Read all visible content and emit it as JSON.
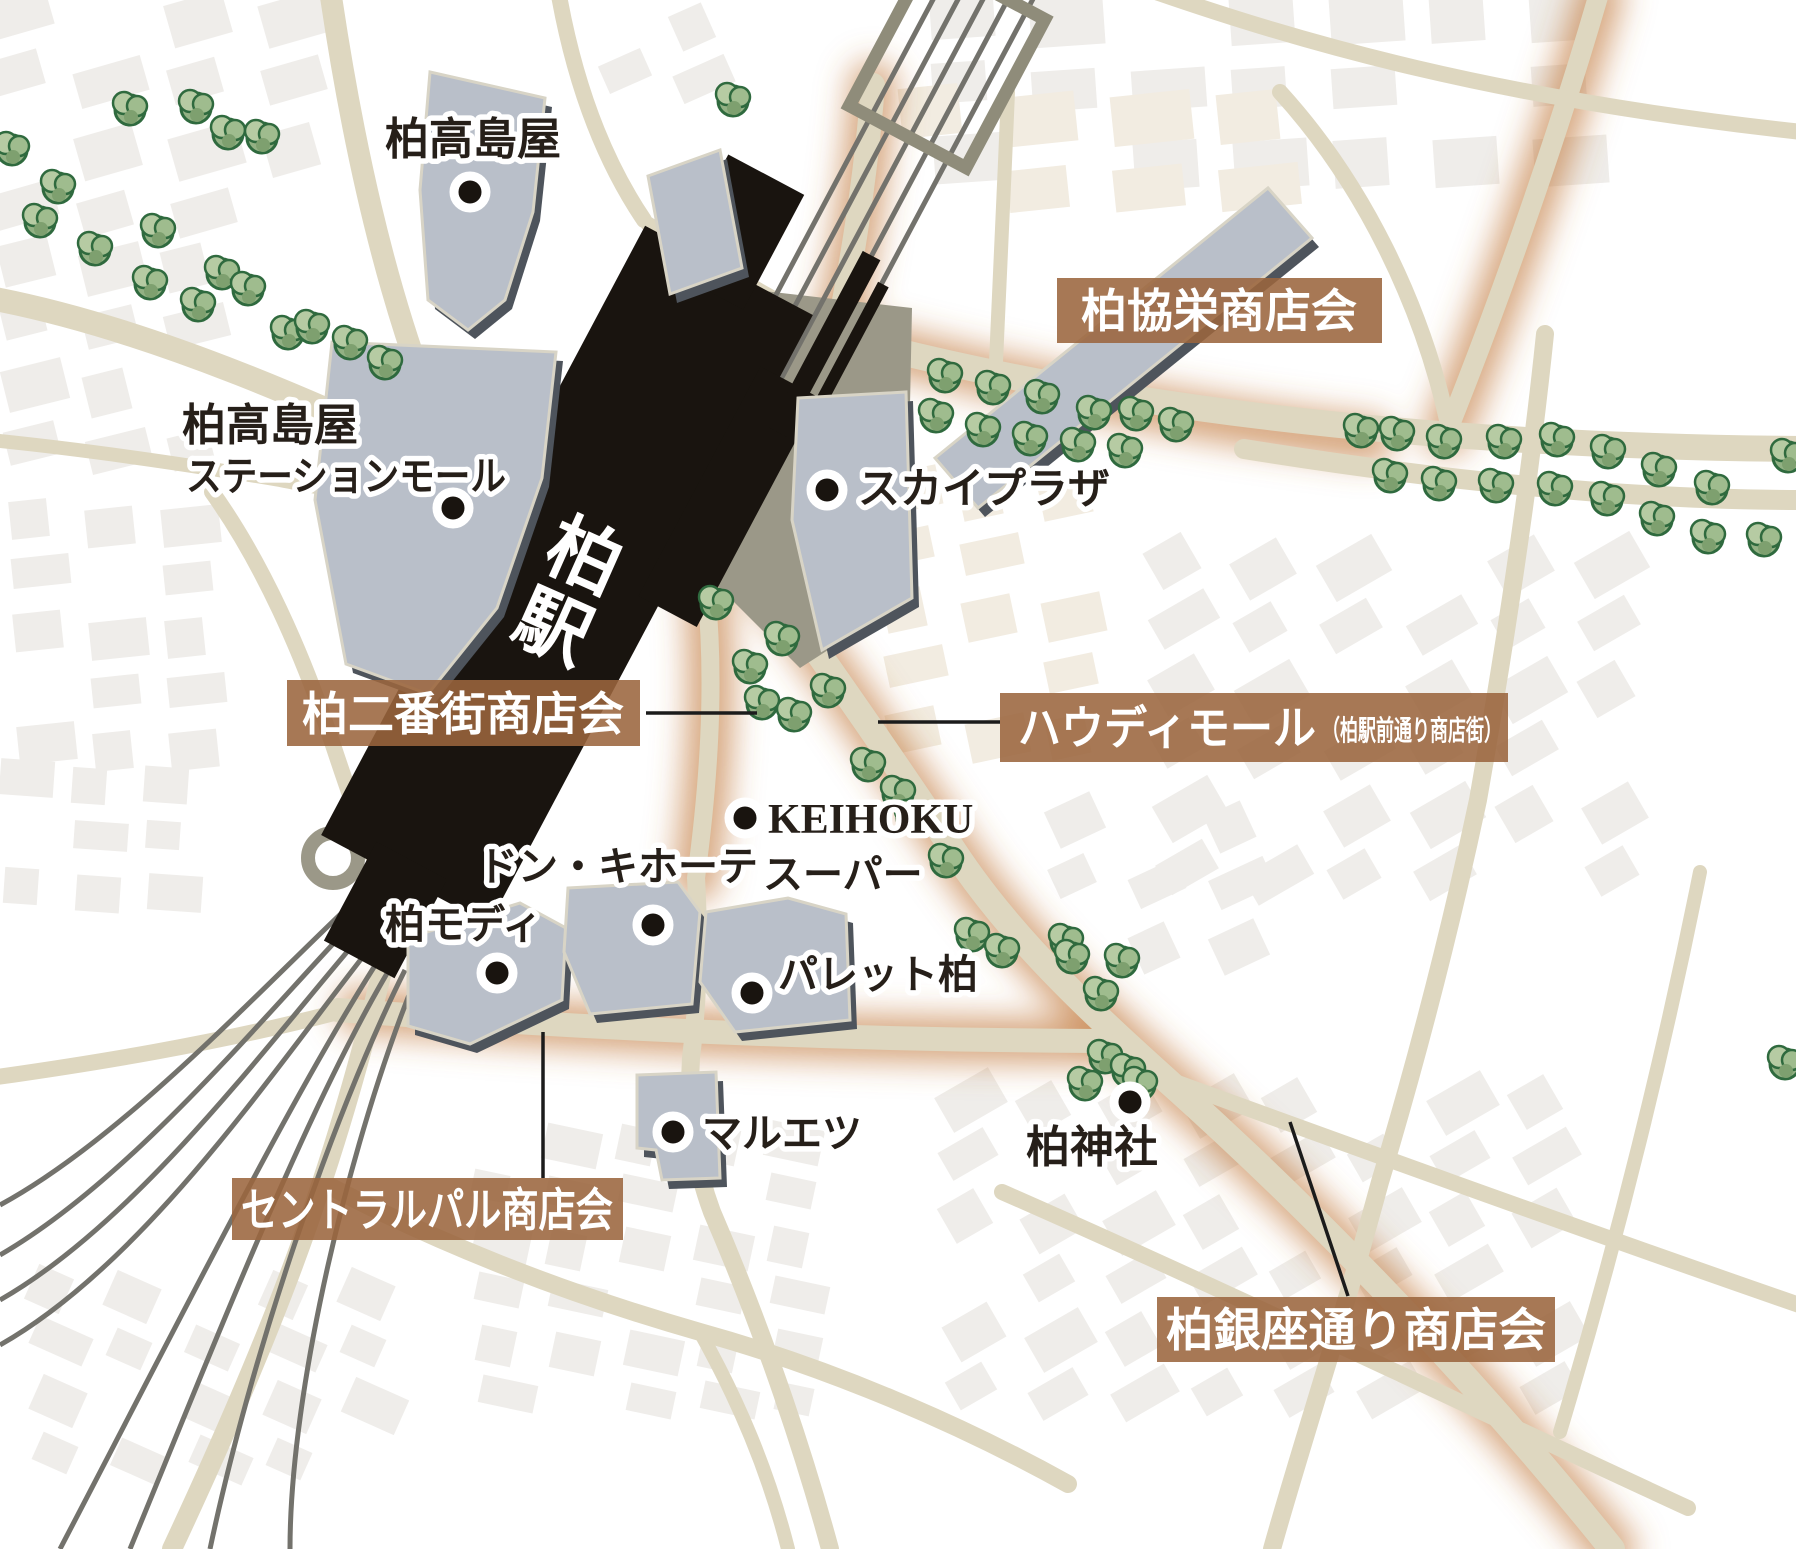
{
  "map": {
    "station": {
      "name": "柏駅",
      "name_line1": "柏",
      "name_line2": "駅"
    },
    "landmarks": [
      {
        "id": "takashimaya",
        "label": "柏高島屋"
      },
      {
        "id": "takashimaya-station-mall",
        "label_line1": "柏高島屋",
        "label_line2": "ステーションモール"
      },
      {
        "id": "sky-plaza",
        "label": "スカイプラザ"
      },
      {
        "id": "keihoku-super",
        "label_line1": "KEIHOKU",
        "label_line2": "スーパー"
      },
      {
        "id": "don-quijote",
        "label": "ドン・キホーテ"
      },
      {
        "id": "kashiwa-modi",
        "label": "柏モディ"
      },
      {
        "id": "palette-kashiwa",
        "label": "パレット柏"
      },
      {
        "id": "maruetsu",
        "label": "マルエツ"
      },
      {
        "id": "kashiwa-shrine",
        "label": "柏神社"
      }
    ],
    "shopping_streets": [
      {
        "id": "kyoei",
        "label": "柏協栄商店会"
      },
      {
        "id": "nibangai",
        "label": "柏二番街商店会"
      },
      {
        "id": "howdy-mall",
        "label": "ハウディモール",
        "label_sub": "（柏駅前通り商店街）"
      },
      {
        "id": "central-pal",
        "label": "セントラルパル商店会"
      },
      {
        "id": "ginza-dori",
        "label": "柏銀座通り商店会"
      }
    ],
    "colors": {
      "badge_brown": "#9b653d",
      "glow_orange": "#c1763a",
      "road_tan": "#ded7c0",
      "block_gray": "#efedea",
      "block_warm": "#f2ece1",
      "building_gray": "#b9bfc9",
      "building_shadow": "#4e545c",
      "deck_gray": "#9b9888",
      "rail_gray": "#73726c",
      "station_black": "#19140f",
      "tree_green": "#93b184",
      "tree_outline": "#2f6a3e"
    }
  }
}
